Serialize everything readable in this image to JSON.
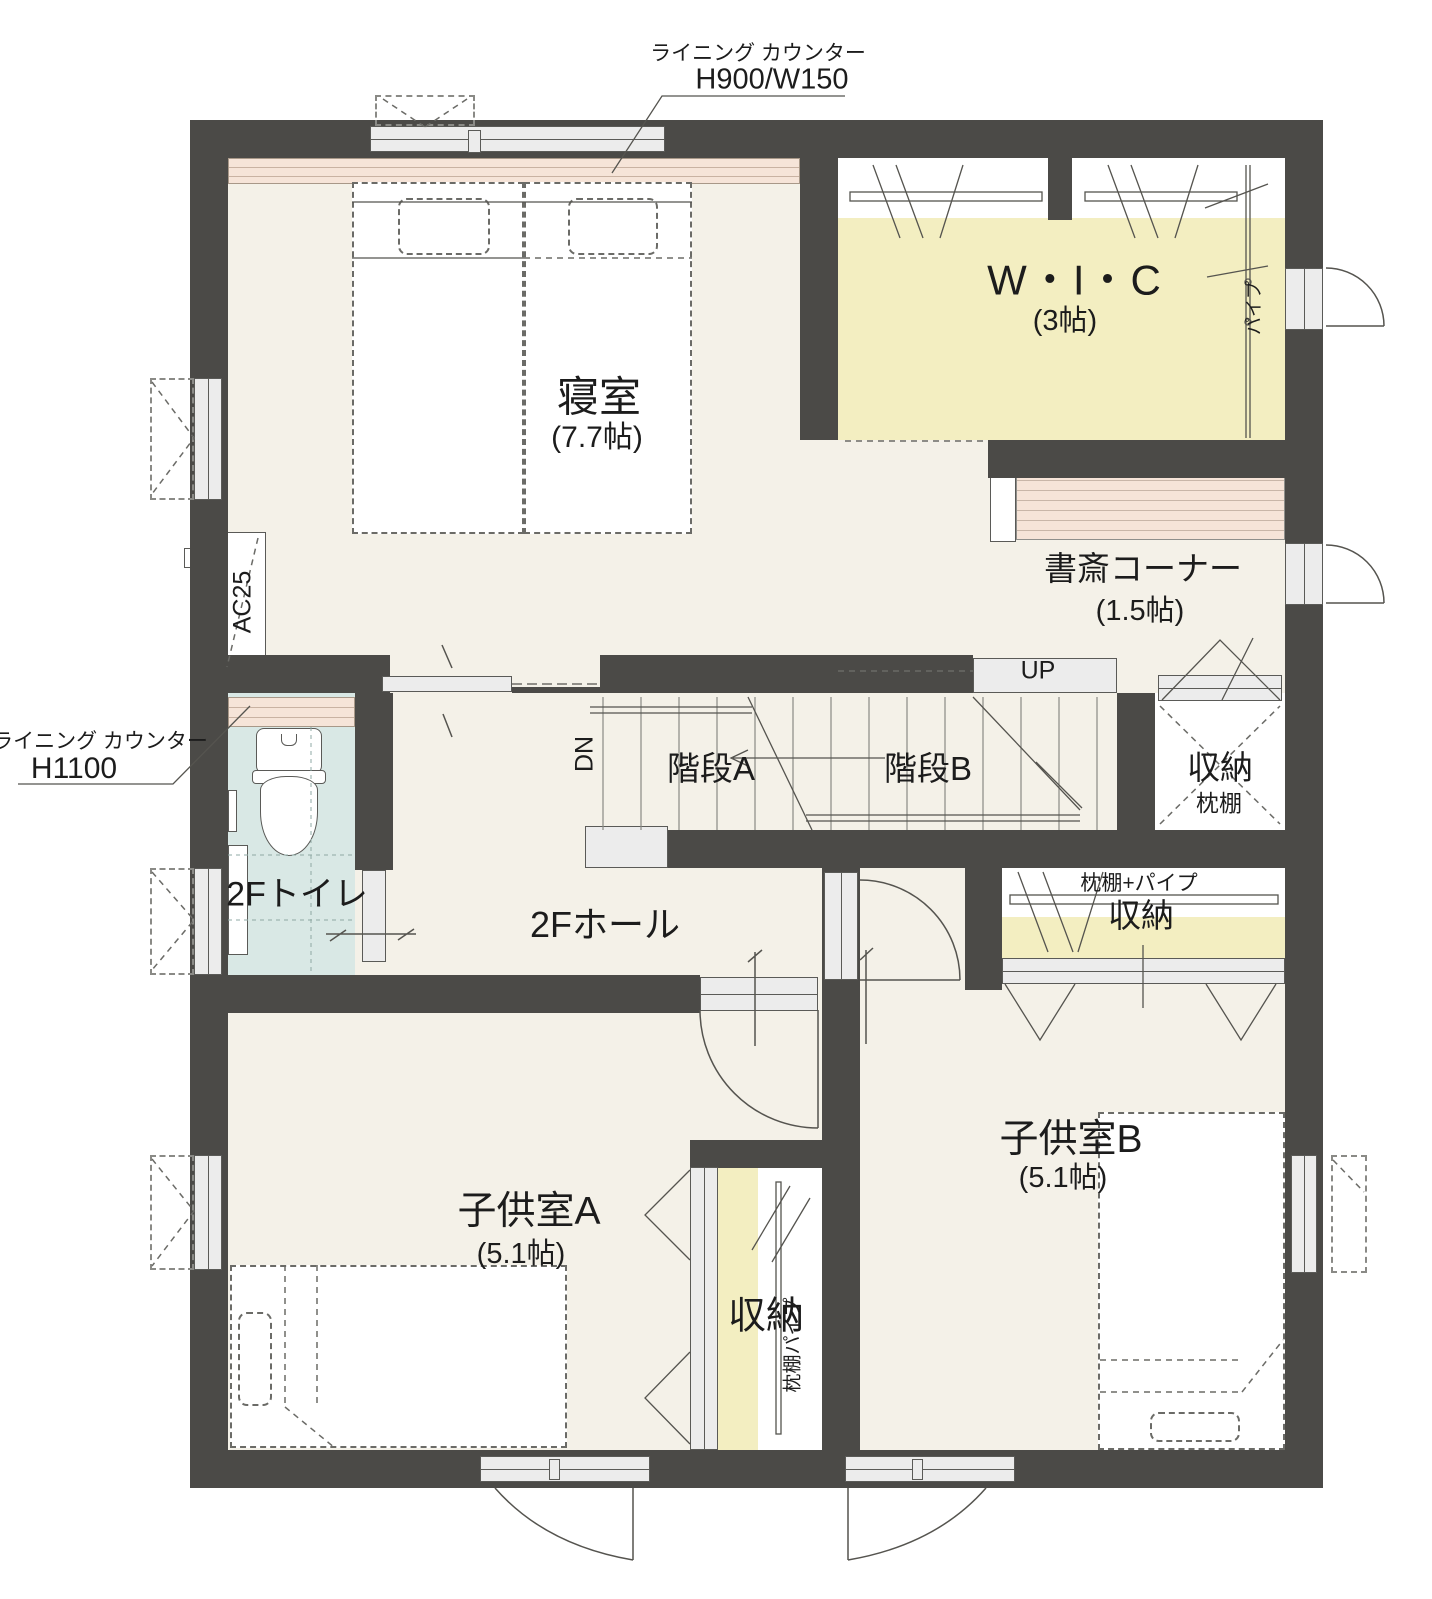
{
  "colors": {
    "wall": "#4b4a47",
    "floor": "#f4f1e8",
    "closet_yellow": "#f3eec1",
    "toilet_blue": "#d9e8e5",
    "counter_pink": "#f6e4d8",
    "window_gray": "#ececec",
    "line": "#555555"
  },
  "rooms": {
    "bedroom": {
      "label": "寝室",
      "size": "(7.7帖)"
    },
    "wic": {
      "label": "W・I・C",
      "size": "(3帖)"
    },
    "study": {
      "label": "書斎コーナー",
      "size": "(1.5帖)"
    },
    "stair_a": {
      "label": "階段A"
    },
    "stair_b": {
      "label": "階段B"
    },
    "toilet": {
      "label": "2Fトイレ"
    },
    "hall": {
      "label": "2Fホール"
    },
    "child_a": {
      "label": "子供室A",
      "size": "(5.1帖)"
    },
    "child_b": {
      "label": "子供室B",
      "size": "(5.1帖)"
    },
    "closet_right": {
      "label": "収納",
      "note": "枕棚"
    },
    "closet_child_b": {
      "label": "収納",
      "note": "枕棚+パイプ"
    },
    "closet_bottom": {
      "label": "収納",
      "note": "枕棚パイプ"
    }
  },
  "annotations": {
    "counter_top": {
      "name": "ライニング カウンター",
      "spec": "H900/W150"
    },
    "counter_left": {
      "name": "ライニング カウンター",
      "spec": "H1100"
    },
    "ac_unit": "AC25",
    "stairs_up": "UP",
    "stairs_down": "DN",
    "pipe": "パイプ"
  }
}
